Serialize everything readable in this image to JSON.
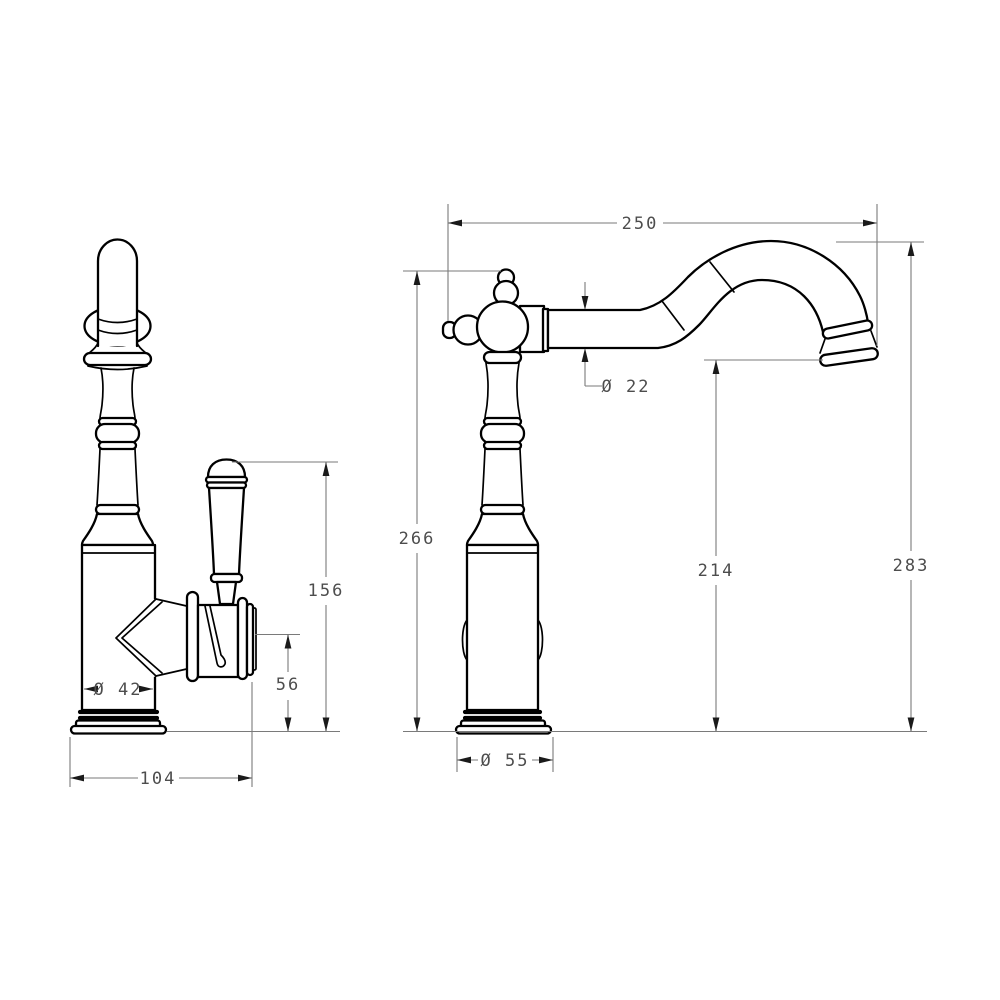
{
  "page": {
    "background": "#ffffff",
    "description": "Technical dimension drawing of a traditional single-lever basin/kitchen tap, two orthographic views"
  },
  "drawing": {
    "units": "mm",
    "object_line_color": "#000000",
    "dimension_line_color": "#7a7a7a",
    "dimension_text_color": "#4d4d4d",
    "views": {
      "side": {
        "name": "side view with lever handle",
        "dims": {
          "height_to_handle_top": "156",
          "height_to_valve_axis": "56",
          "body_diameter": "Ø 42",
          "overall_depth": "104"
        }
      },
      "front": {
        "name": "front view with swan-neck spout",
        "dims": {
          "spout_reach": "250",
          "spout_pipe_diameter": "Ø 22",
          "height_to_valve_top": "266",
          "spout_outlet_height": "214",
          "overall_height": "283",
          "base_diameter": "Ø 55"
        }
      }
    }
  }
}
